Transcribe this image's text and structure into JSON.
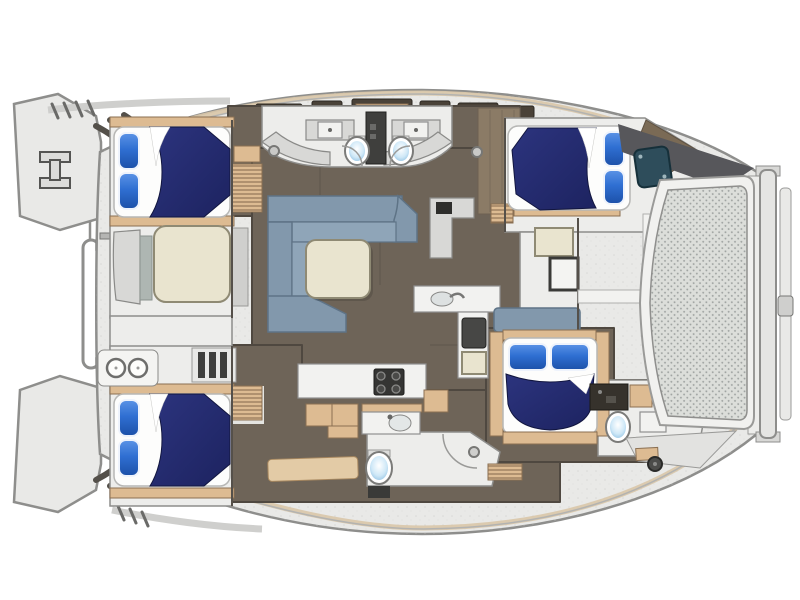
{
  "diagram": {
    "type": "catamaran-yacht-floor-plan",
    "view": "top-down-deck-plan",
    "features": {
      "double_berths": 4,
      "pillows_per_berth": 2,
      "toilets": 4,
      "salon_sofa": 1,
      "salon_table": 1,
      "forward_ottoman": 1,
      "galley_stove_burners": 4,
      "cooktop_rings": 2,
      "sinks": 4,
      "cockpit_table": 1,
      "bow_step_flights": 2,
      "foredeck_crossbeam_rail": 1,
      "stern_davit_rails": 2,
      "cockpit_mesh_panel": 1
    }
  },
  "palette": {
    "deck": "#e9e9e7",
    "deck_edge": "#8e8e8c",
    "deck_band": "#d9c7a9",
    "floor": "#6e6458",
    "floor_edge": "#4f4840",
    "room": "#ededeb",
    "wood": "#ddbb92",
    "wood_edge": "#8a6f52",
    "navy": "#232a6b",
    "pillow": "#2f6fd2",
    "pillow_deep": "#1c50a8",
    "sofa": "#8298ac",
    "sofa_edge": "#5e7386",
    "sofa_seat": "#8fa5b8",
    "cream": "#e9e4cf",
    "cream_edge": "#8f8a74",
    "teal": "#2e4d5b",
    "mesh_bg": "#dcdeda",
    "mesh_dot": "#a0a4a2",
    "toilet_seat": "#a9cfe9",
    "dark": "#3c3c3a",
    "hatch": "#4a4238",
    "wedge": "#57575b"
  }
}
